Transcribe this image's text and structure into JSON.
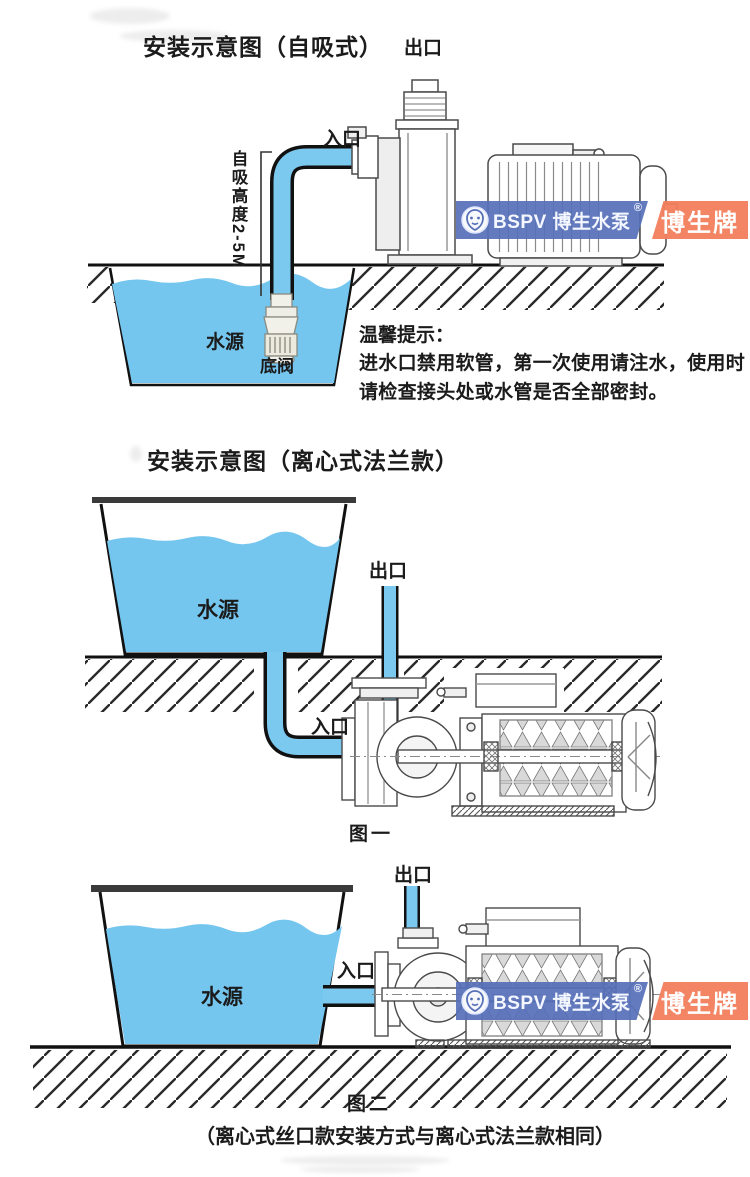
{
  "colors": {
    "water": "#74C6EF",
    "pipe": "#7CC9F0",
    "ink": "#1b1b1b",
    "badge_blue": "#5670B8",
    "badge_red": "#F2805E",
    "tank_lid": "#3a3a3a"
  },
  "watermark": {
    "logo": "lion-shield",
    "brand": "BSPV 博生水泵",
    "reg": "®",
    "badge": "博生牌"
  },
  "s1": {
    "title": "安装示意图（自吸式）",
    "outlet": "出口",
    "inlet": "入口",
    "suction_height": "自吸高度2-5M",
    "water_source": "水源",
    "foot_valve": "底阀",
    "tips_title": "温馨提示：",
    "tips_body": "进水口禁用软管，第一次使用请注水，使用时请检查接头处或水管是否全部密封。"
  },
  "s2": {
    "title": "安装示意图（离心式法兰款）",
    "outlet": "出口",
    "inlet": "入口",
    "water_source": "水源",
    "caption": "图一"
  },
  "s3": {
    "outlet": "出口",
    "inlet": "入口",
    "water_source": "水源",
    "caption": "图二",
    "note": "（离心式丝口款安装方式与离心式法兰款相同）"
  }
}
